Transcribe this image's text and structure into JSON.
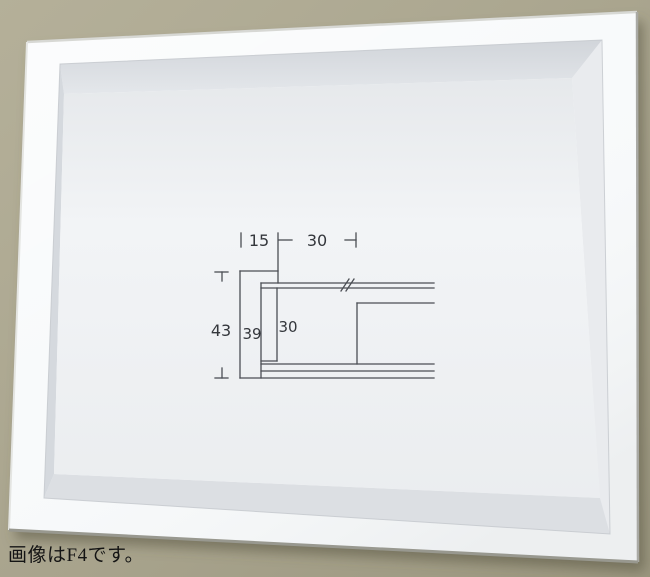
{
  "photo": {
    "caption": "画像はF4です。"
  },
  "diagram": {
    "labels": {
      "top_width_face": "15",
      "top_width_opening": "30",
      "left_total_height": "43",
      "inner_depth": "39",
      "inner_opening": "30"
    }
  },
  "colors": {
    "wall": "#aca78f",
    "frame_face": "#f8fafb",
    "inner_wall_top": "#e4e7eb",
    "inner_wall_left": "#d5d9de",
    "inner_wall_right": "#e9ebee",
    "inner_wall_bottom": "#dcdfe3",
    "back_panel": "#f2f4f6",
    "diagram_line": "#4b4e54",
    "diagram_text": "#34373c",
    "caption_text": "#141414"
  }
}
